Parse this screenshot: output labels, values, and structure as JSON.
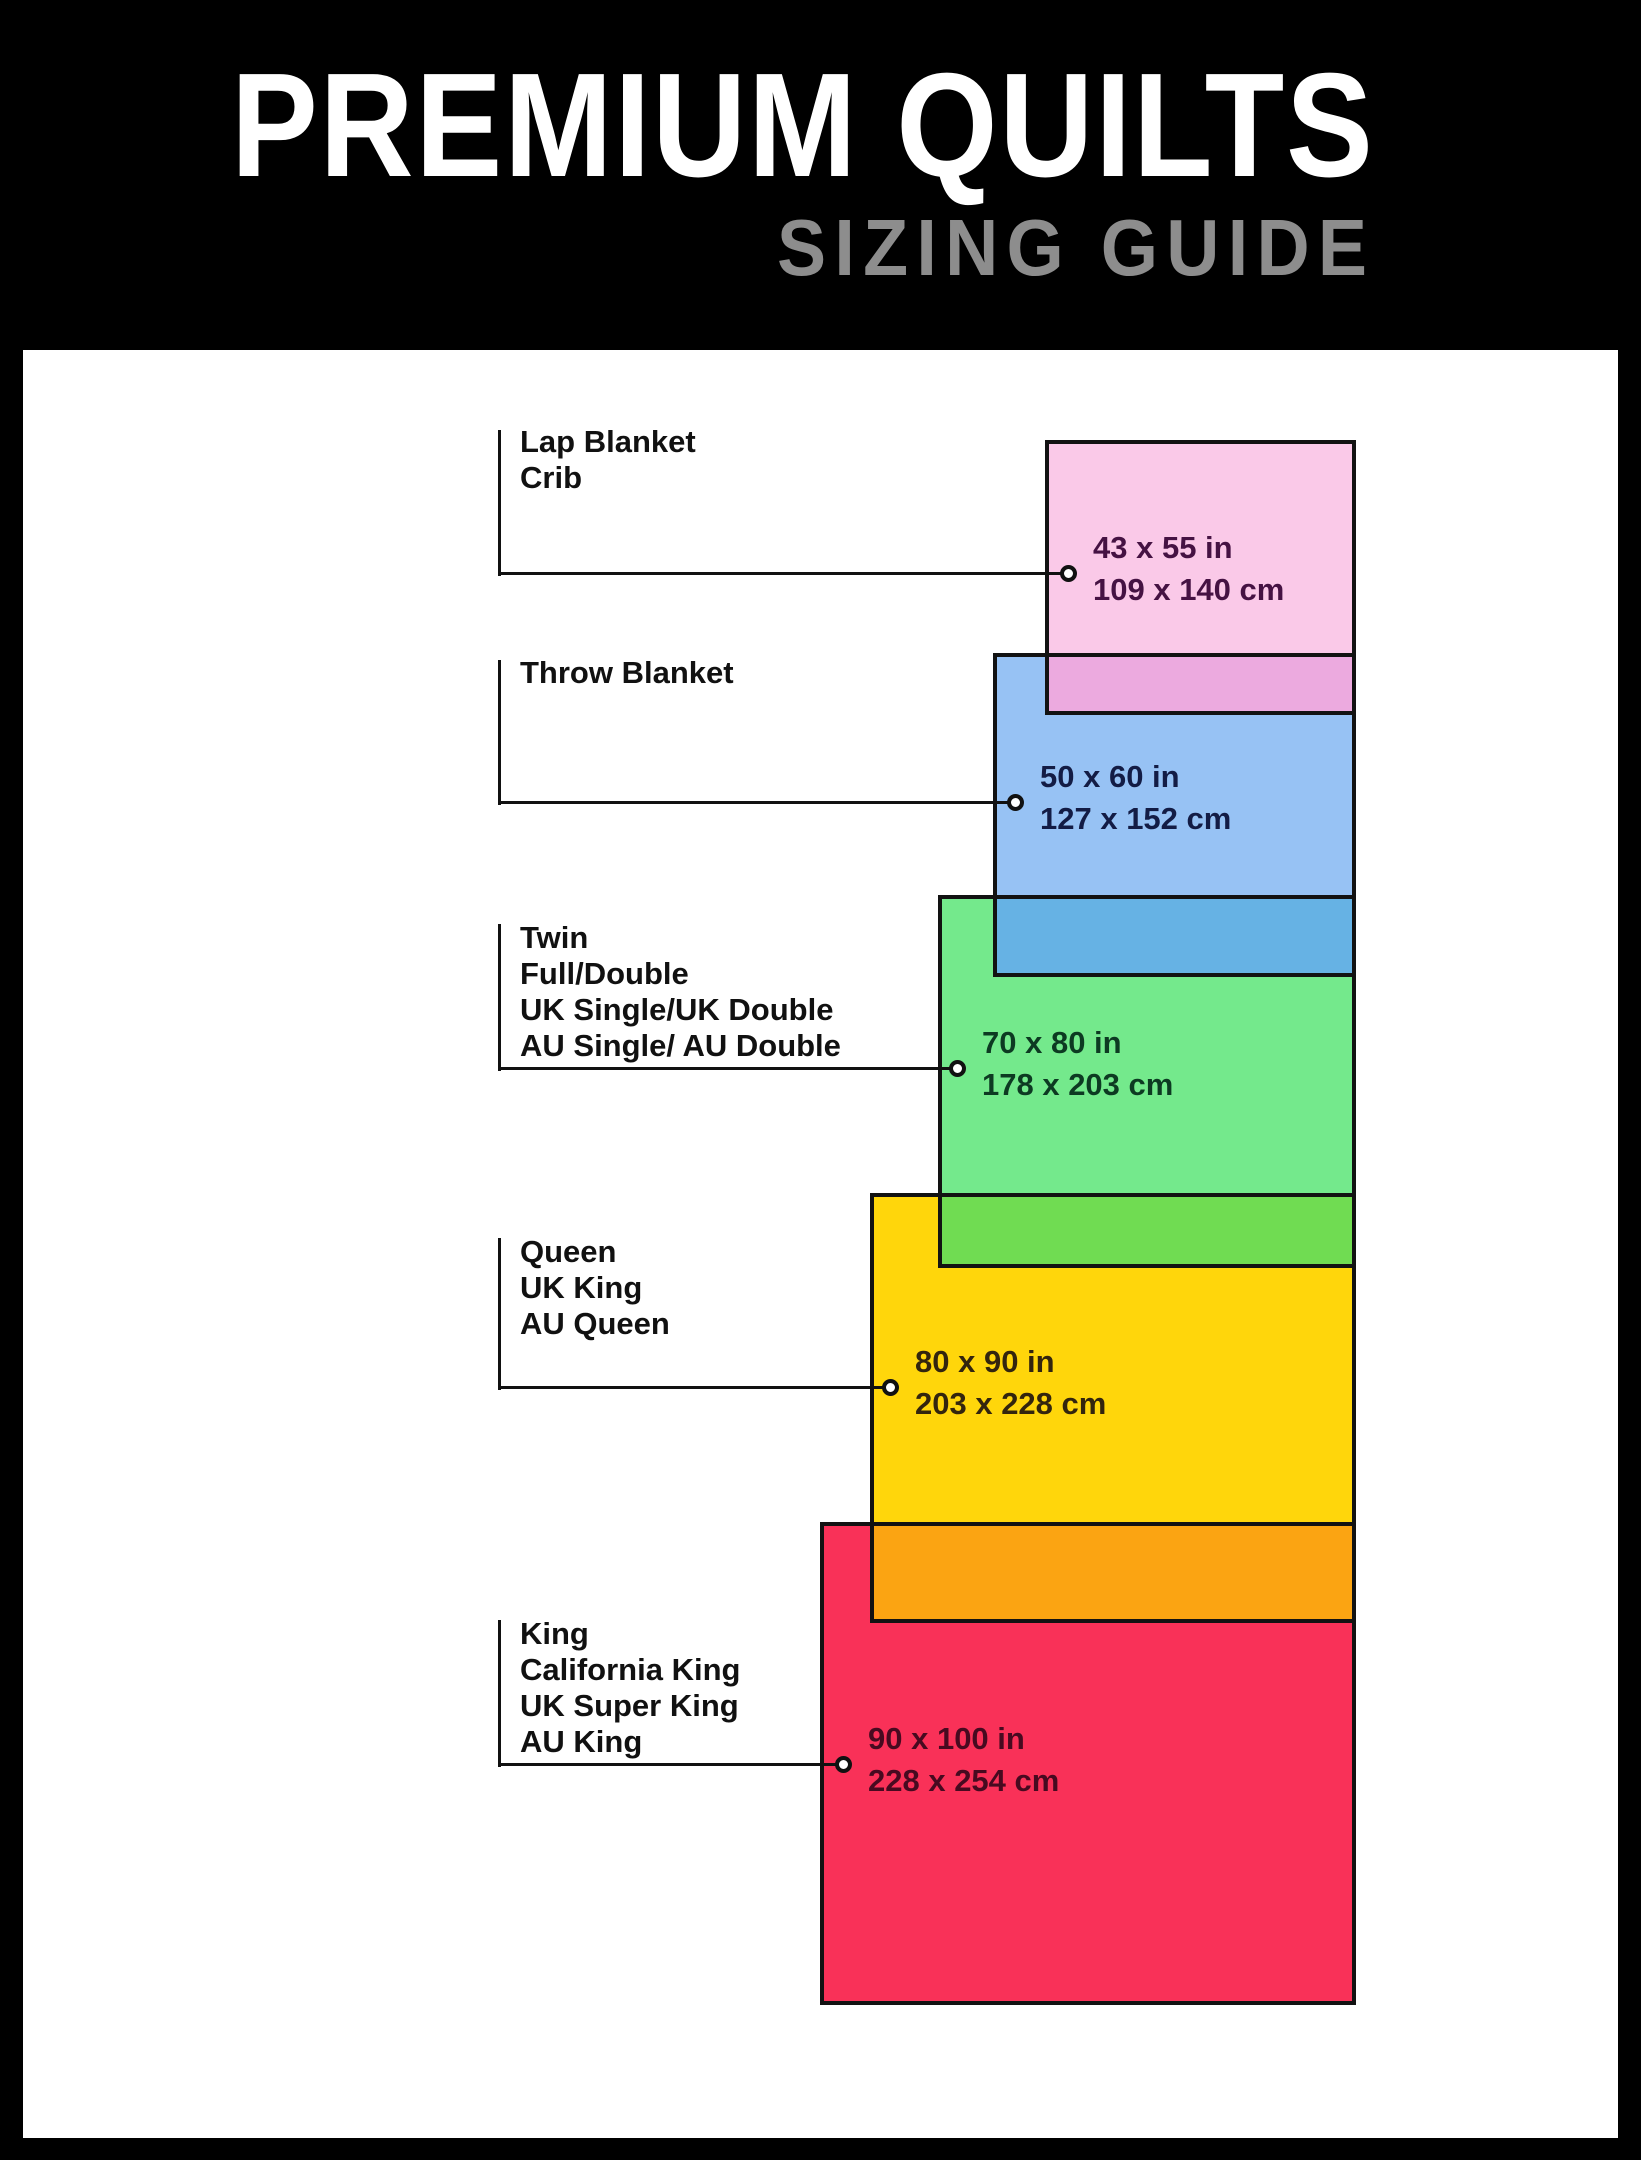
{
  "header": {
    "title": "PREMIUM QUILTS",
    "subtitle": "SIZING GUIDE",
    "bg_color": "#000000",
    "title_color": "#ffffff",
    "subtitle_color": "#8d8d8d"
  },
  "panel": {
    "bg_color": "#ffffff"
  },
  "chart_data": {
    "type": "area",
    "title": "Premium Quilts Sizing Guide",
    "note": "Nested rectangles compare quilt sizes, all aligned to a shared right edge",
    "sizes": [
      {
        "key": "lap-crib",
        "label_lines": [
          "Lap Blanket",
          "Crib"
        ],
        "dim_in": "43 x 55 in",
        "dim_cm": "109 x 140 cm",
        "fill": "#FAC9E8",
        "text_color": "#451243",
        "rect": {
          "left": 1045,
          "top": 440,
          "width": 311,
          "height": 275
        },
        "label": {
          "text_left": 520,
          "text_top": 424
        },
        "leader": {
          "x": 498,
          "v_top": 430,
          "y": 573,
          "circle_x": 1068
        },
        "dim_x": 1093
      },
      {
        "key": "throw",
        "label_lines": [
          "Throw Blanket"
        ],
        "dim_in": "50 x 60 in",
        "dim_cm": "127 x 152 cm",
        "fill": "#97C2F4",
        "text_color": "#131C45",
        "rect": {
          "left": 993,
          "top": 653,
          "width": 363,
          "height": 324
        },
        "label": {
          "text_left": 520,
          "text_top": 655
        },
        "leader": {
          "x": 498,
          "v_top": 660,
          "y": 802,
          "circle_x": 1015
        },
        "dim_x": 1040
      },
      {
        "key": "twin-full",
        "label_lines": [
          "Twin",
          "Full/Double",
          "UK Single/UK Double",
          "AU Single/ AU Double"
        ],
        "dim_in": "70 x 80 in",
        "dim_cm": "178 x 203 cm",
        "fill": "#74E98C",
        "text_color": "#0D3A22",
        "rect": {
          "left": 938,
          "top": 895,
          "width": 418,
          "height": 373
        },
        "label": {
          "text_left": 520,
          "text_top": 920
        },
        "leader": {
          "x": 498,
          "v_top": 924,
          "y": 1068,
          "circle_x": 957
        },
        "dim_x": 982
      },
      {
        "key": "queen",
        "label_lines": [
          "Queen",
          "UK King",
          "AU Queen"
        ],
        "dim_in": "80 x 90 in",
        "dim_cm": "203 x 228 cm",
        "fill": "#FFD60B",
        "text_color": "#33250E",
        "rect": {
          "left": 870,
          "top": 1193,
          "width": 486,
          "height": 430
        },
        "label": {
          "text_left": 520,
          "text_top": 1234
        },
        "leader": {
          "x": 498,
          "v_top": 1238,
          "y": 1387,
          "circle_x": 890
        },
        "dim_x": 915
      },
      {
        "key": "king",
        "label_lines": [
          "King",
          "California King",
          "UK Super King",
          "AU King"
        ],
        "dim_in": "90 x 100 in",
        "dim_cm": "228 x 254 cm",
        "fill": "#F93158",
        "text_color": "#470A20",
        "rect": {
          "left": 820,
          "top": 1522,
          "width": 536,
          "height": 483
        },
        "label": {
          "text_left": 520,
          "text_top": 1616
        },
        "leader": {
          "x": 498,
          "v_top": 1620,
          "y": 1764,
          "circle_x": 843
        },
        "dim_x": 868
      }
    ],
    "overlaps": [
      {
        "between": "lap-over-throw",
        "color": "#ECAADF",
        "left": 1045,
        "top": 653,
        "width": 311,
        "height": 62
      },
      {
        "between": "throw-over-twin",
        "color": "#66B2E4",
        "left": 993,
        "top": 895,
        "width": 363,
        "height": 82
      },
      {
        "between": "twin-over-queen",
        "color": "#70DC52",
        "left": 938,
        "top": 1193,
        "width": 418,
        "height": 75
      },
      {
        "between": "queen-over-king",
        "color": "#FBA412",
        "left": 870,
        "top": 1522,
        "width": 486,
        "height": 101
      }
    ],
    "border_color": "#121212"
  }
}
